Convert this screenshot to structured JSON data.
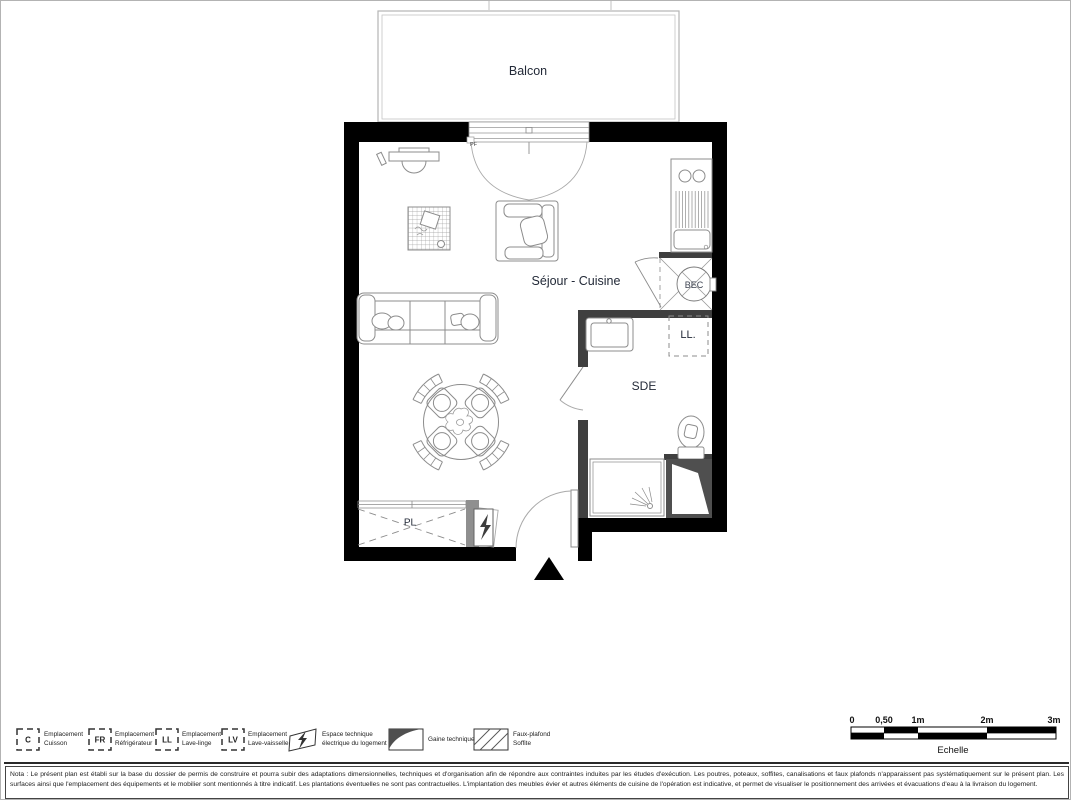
{
  "plan": {
    "balcony_label": "Balcon",
    "window_label": "PF",
    "living_kitchen_label": "Séjour - Cuisine",
    "shower_room_label": "SDE",
    "closet_label": "PL",
    "washer_location_label": "LL.",
    "water_heater_label": "BEC"
  },
  "legend": {
    "items": [
      {
        "code": "C",
        "line1": "Emplacement",
        "line2": "Cuisson"
      },
      {
        "code": "FR",
        "line1": "Emplacement",
        "line2": "Réfrigérateur"
      },
      {
        "code": "LL",
        "line1": "Emplacement",
        "line2": "Lave-linge"
      },
      {
        "code": "LV",
        "line1": "Emplacement",
        "line2": "Lave-vaisselle"
      },
      {
        "code": "",
        "line1": "Espace technique",
        "line2": "électrique du logement"
      },
      {
        "code": "",
        "line1": "Gaine technique",
        "line2": ""
      },
      {
        "code": "",
        "line1": "Faux-plafond",
        "line2": "Soffite"
      }
    ]
  },
  "scale_bar": {
    "ticks": [
      "0",
      "0,50",
      "1m",
      "2m",
      "3m"
    ],
    "label": "Echelle"
  },
  "nota": {
    "text": "Nota : Le présent plan est établi sur la base du dossier de permis de construire et pourra subir des adaptations dimensionnelles, techniques et d'organisation afin de répondre aux contraintes induites par les études d'exécution. Les poutres, poteaux, soffites, canalisations et faux plafonds n'apparaissent pas systématiquement sur le présent plan. Les surfaces ainsi que l'emplacement des équipements et le mobilier sont mentionnés à titre indicatif. Les plantations éventuelles ne sont pas contractuelles. L'implantation des meubles évier et autres éléments de cuisine de l'opération est indicative, et permet de visualiser le positionnement des arrivées et évacuations d'eau à la livraison du logement."
  },
  "colors": {
    "wall": "#000000",
    "partition": "#3f3f3f",
    "technical_duct_fill": "#4f4f4f",
    "furniture_stroke": "#8c8c8c",
    "balcony_stroke": "#b5b5b5",
    "label_text": "#232a38"
  }
}
